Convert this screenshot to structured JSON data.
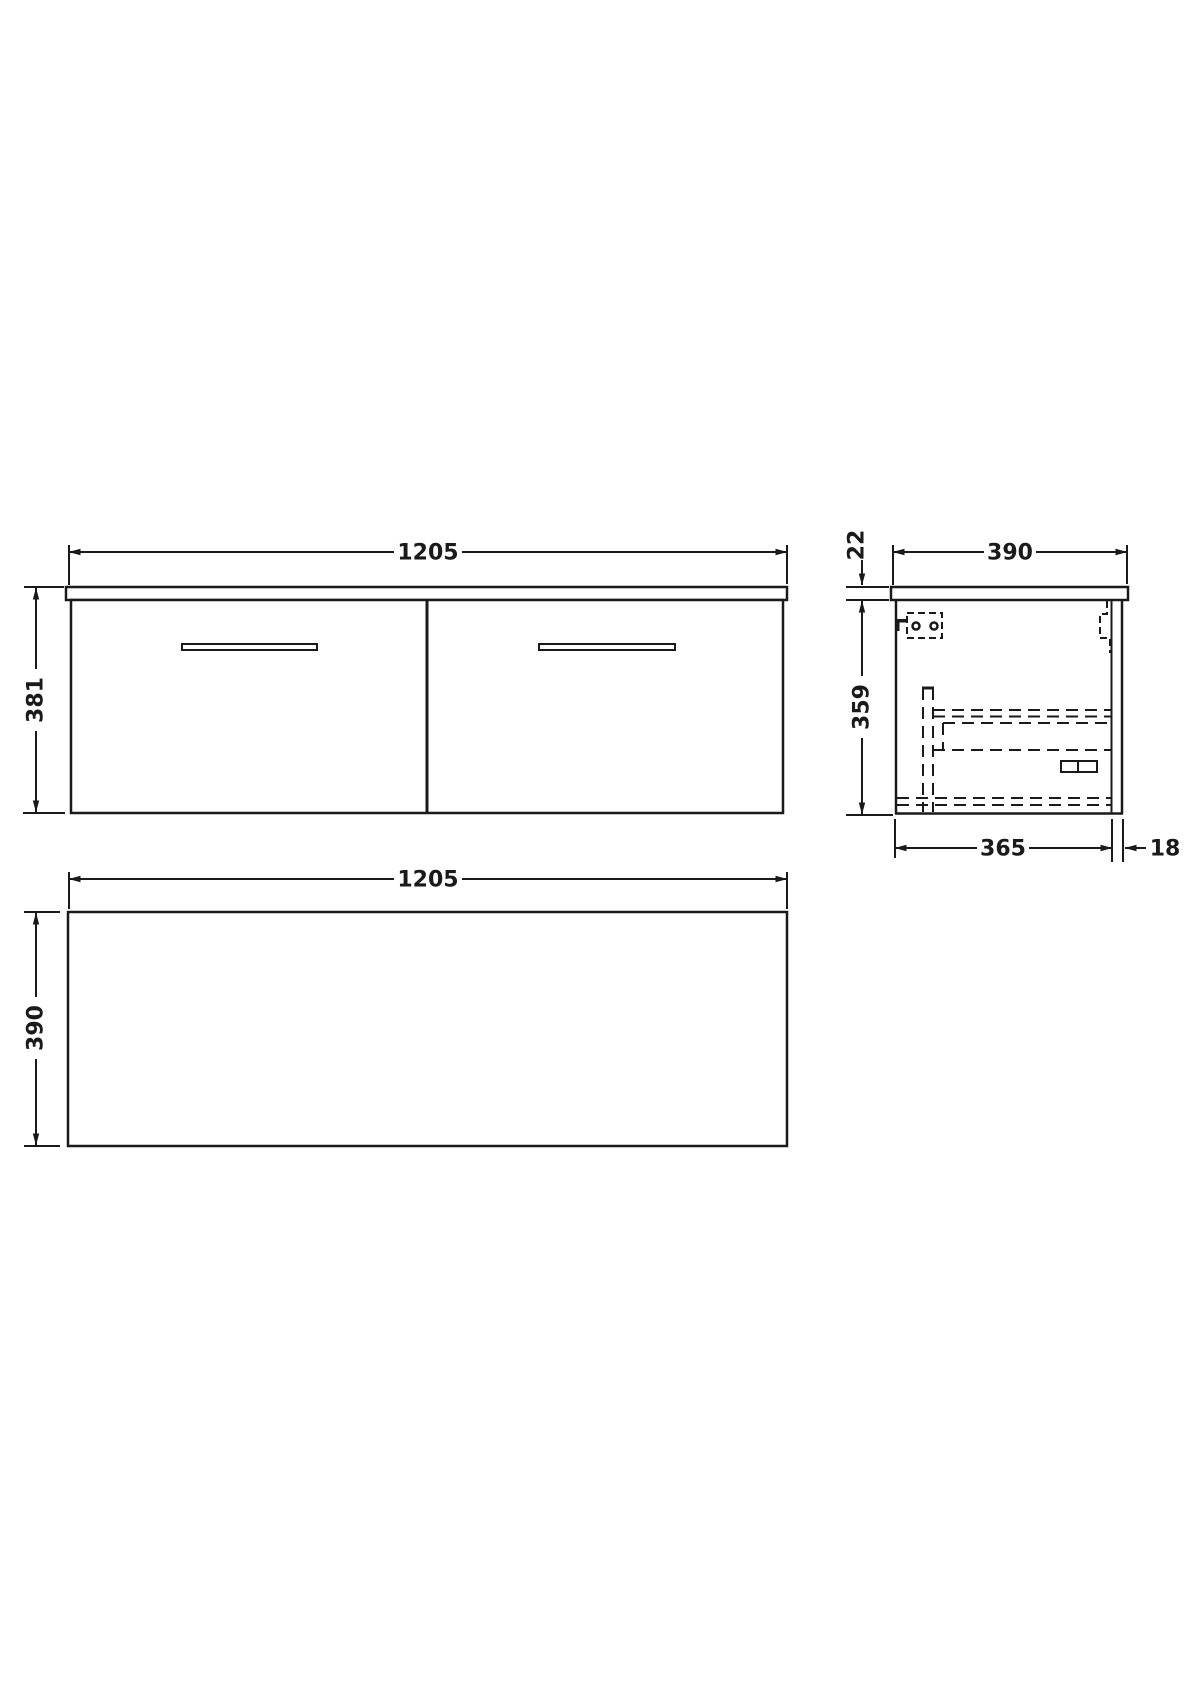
{
  "page": {
    "background_color": "#ffffff",
    "line_color": "#1a1a1a",
    "drawing_type": "wall-hung two-drawer vanity unit dimension drawing"
  },
  "drawing": {
    "views": {
      "front": {
        "width_mm": "1205",
        "height_mm": "381"
      },
      "side": {
        "depth_mm": "390",
        "worktop_thickness_mm": "22",
        "cabinet_height_mm": "359",
        "cabinet_depth_mm": "365",
        "back_panel_mm": "18"
      },
      "plan": {
        "width_mm": "1205",
        "depth_mm": "390"
      }
    }
  }
}
